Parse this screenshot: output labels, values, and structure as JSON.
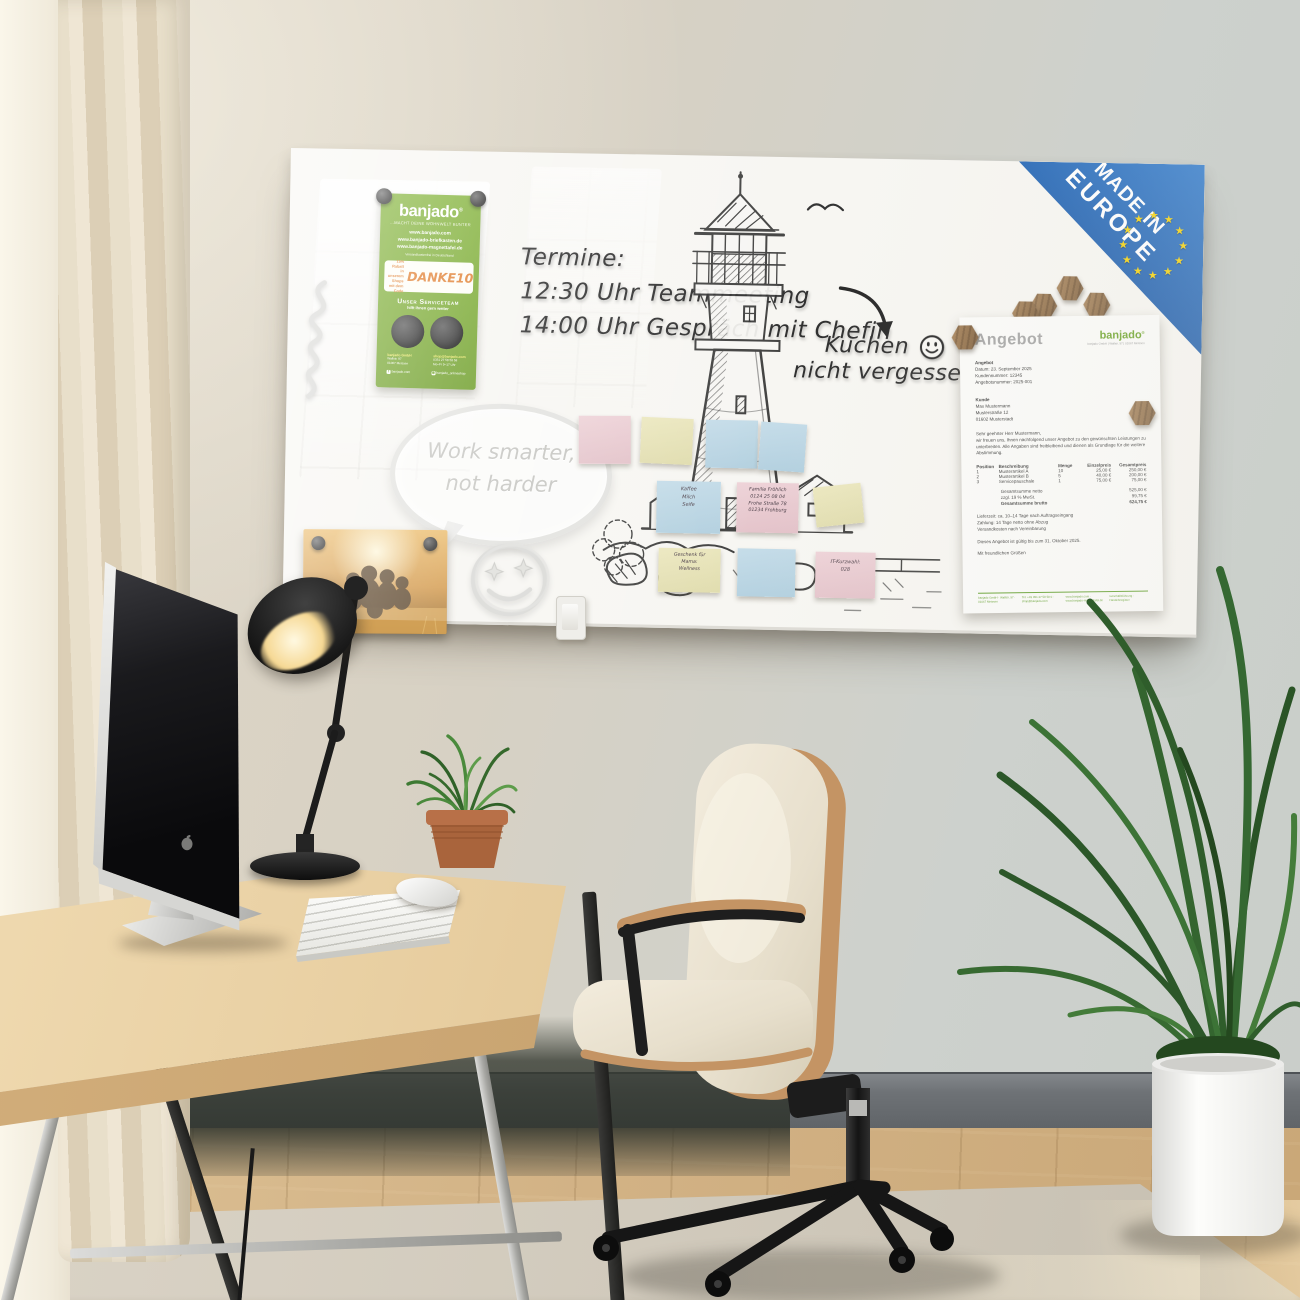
{
  "board": {
    "badge": {
      "line1": "MADE IN",
      "line2": "EUROPE"
    },
    "handwriting": {
      "termine_title": "Termine:",
      "appointment1": "12:30 Uhr Teammeeting",
      "appointment2": "14:00 Uhr Gespräch mit Chefin",
      "cake_line1": "Kuchen",
      "cake_line2": "nicht vergessen",
      "bubble_line1": "Work smarter,",
      "bubble_line2": "not harder"
    },
    "flyer": {
      "brand": "banjado",
      "reg": "®",
      "tagline": "…MACHT DEINE WOHNWELT BUNTER",
      "url1": "www.banjado.com",
      "url2": "www.banjado-briefkasten.de",
      "url3": "www.banjado-magnettafel.de",
      "shipping_note": "Versandkostenfrei in Deutschland",
      "discount_line1": "15% Rabatt",
      "discount_line2": "in unserem Shops",
      "discount_line3": "mit dem Code",
      "discount_code": "DANKE10",
      "service_title": "Unser Serviceteam",
      "service_sub": "hilft Ihnen gern weiter",
      "contact_left_title": "banjado GmbH",
      "contact_left_line1": "Wallstr. 97",
      "contact_left_line2": "01067 Meissen",
      "contact_right_title": "shop@banjado.com",
      "contact_right_line1": "0351 27 58 58 58",
      "contact_right_line2": "Mo–Fr 9–17 Uhr",
      "social_left": "banjado.com",
      "social_right": "banjado_onlineshop"
    },
    "stickies": {
      "kaffee": {
        "line1": "Kaffee",
        "line2": "Milch",
        "line3": "Seife"
      },
      "froehlich": {
        "line1": "Familie Fröhlich",
        "line2": "0124 25 08 04",
        "line3": "Frohe Straße 78",
        "line4": "01234 Frohburg"
      },
      "geschenk": {
        "line1": "Geschenk für",
        "line2": "Mama:",
        "line3": "Wellness"
      },
      "kurzwahl": {
        "line1": "IT-Kurzwahl:",
        "line2": "028"
      }
    },
    "document": {
      "title": "Angebot",
      "brand": "banjado",
      "reg": "®",
      "brand_sub": "banjado GmbH | Wallstr. 97 | 01067 Meissen",
      "meta_title": "Angebot",
      "meta_line1": "Datum: 23. September 2025",
      "meta_line2": "Kundennummer: 12345",
      "meta_line3": "Angebotsnummer: 2025-001",
      "customer_title": "Kunde",
      "customer_line1": "Max Mustermann",
      "customer_line2": "Musterstraße 12",
      "customer_line3": "01602 Musterstadt",
      "salutation": "Sehr geehrter Herr Mustermann,",
      "intro": "wir freuen uns, Ihnen nachfolgend unser Angebot zu den gewünschten Leistungen zu unterbreiten. Alle Angaben sind freibleibend und dienen als Grundlage für die weitere Abstimmung.",
      "col_position": "Position",
      "col_description": "Beschreibung",
      "col_qty": "Menge",
      "col_unit": "Einzelpreis",
      "col_total": "Gesamtpreis",
      "rows": [
        [
          "1",
          "Musterartikel A",
          "10",
          "25,00 €",
          "250,00 €"
        ],
        [
          "2",
          "Musterartikel B",
          "5",
          "40,00 €",
          "200,00 €"
        ],
        [
          "3",
          "Servicepauschale",
          "1",
          "75,00 €",
          "75,00 €"
        ]
      ],
      "total_net_label": "Gesamtsumme netto",
      "total_net": "525,00 €",
      "vat_label": "zzgl. 19 % MwSt.",
      "vat": "99,75 €",
      "total_gross_label": "Gesamtsumme brutto",
      "total_gross": "624,75 €",
      "term1": "Lieferzeit: ca. 10–14 Tage nach Auftragseingang",
      "term2": "Zahlung: 14 Tage netto ohne Abzug",
      "term3": "Versandkosten nach Vereinbarung",
      "validity": "Dieses Angebot ist gültig bis zum 31. Oktober 2025.",
      "closing": "Mit freundlichen Grüßen",
      "footer_col1": "banjado GmbH · Wallstr. 97 · 01067 Meissen",
      "footer_col2": "Tel. +49 351 27 58 58 0 · shop@banjado.com",
      "footer_col3": "www.banjado.com · www.banjado-magnettafel.de",
      "footer_col4": "Geschäftsführung · Handelsregister"
    }
  },
  "colors": {
    "flyer_green": "#74a629",
    "badge_blue": "#1d5cab",
    "star_yellow": "#f5d20a",
    "doc_green": "#5f9e29",
    "sticky_pink": "#e8ccd1",
    "sticky_yellow": "#e9e5bd",
    "sticky_blue": "#bfd9e6",
    "handwriting": "#2f2f2f"
  },
  "icons": {
    "star": "★",
    "facebook": "f",
    "instagram": "◉"
  }
}
